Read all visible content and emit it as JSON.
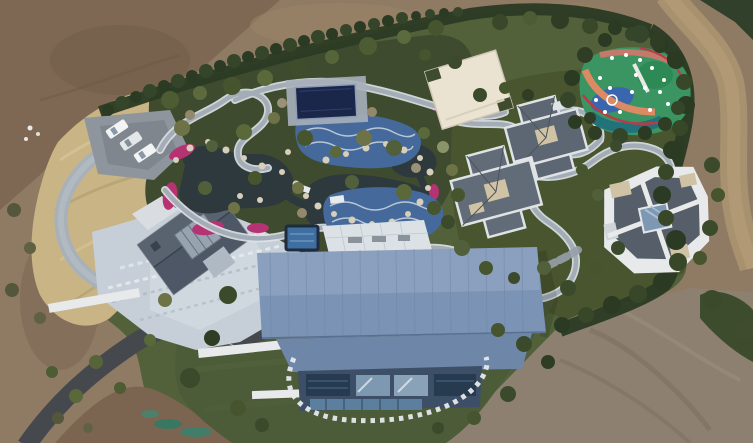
{
  "scene": {
    "type": "aerial-drone-photograph",
    "subject": "top-down view of a landscaped private estate compound surrounded by freshly graded bare earth",
    "visible_elements": [
      "bare brown earth surrounding the estate on all sides",
      "dark perimeter hedge and tree belt along the north boundary",
      "dirt service road curving along the north-east corner",
      "gravel parking pad with three white cars",
      "dry tan ornamental grass bank beside the driveway loop",
      "dark asphalt driveway entering from the south-west corner",
      "stone-paved terrace and gray gabled house on the west side",
      "water garden with dark ponds, rock edges and magenta flower beds",
      "winding light-gray garden paths",
      "dark navy flat pavilion roof beside blue mosaic pool decks",
      "cream flat-roofed outbuilding",
      "multicolour splash-pad playground with slides at the north-east",
      "two cross-shaped villas with slate hip roofs and tan roof decks",
      "modern villa with white parapets and central glass atrium on the east",
      "large steel-blue standing-seam roof of the main house with glass south facade",
      "curved white stepping-stone path looping across the south lawn",
      "mown lawn with young trees and graded dirt at the south-east"
    ]
  },
  "colors": {
    "dirt_base": "#8f7b64",
    "dirt_dark": "#7b6550",
    "dirt_gray": "#8d8070",
    "road_dirt": "#a8916e",
    "road_dirt_light": "#b29b76",
    "dry_grass": "#c9b486",
    "estate_green": "#53613b",
    "garden_green": "#3e4b2e",
    "lawn_green": "#4c5b38",
    "villa_green": "#49552f",
    "hedge_green": "#2b3a23",
    "pond": "#2d393d",
    "flower": "#b53273",
    "rock": "#d8cfba",
    "path_casing": "#dfe3e7",
    "path_gray": "#a2adb8",
    "asphalt": "#45494d",
    "terrace": "#c6cfd7",
    "white_wall": "#e7e9eb",
    "roof_blue": "#7b93b5",
    "roof_blue_low": "#6e87a9",
    "facade": "#3c4f66",
    "glass_pale": "#7d98b0",
    "navy_roof": "#1a274b",
    "cream": "#ebe3d1",
    "villa_roof": "#5d6773",
    "villa_tan": "#d0c3a5",
    "left_roof": "#4d5765",
    "pool_blue": "#44699a",
    "play_green": "#3a9563",
    "play_teal": "#21727a",
    "play_blue": "#3a66ad",
    "play_orange": "#dc8a64",
    "play_red": "#b93b49",
    "car_white": "#f2f3f4"
  }
}
